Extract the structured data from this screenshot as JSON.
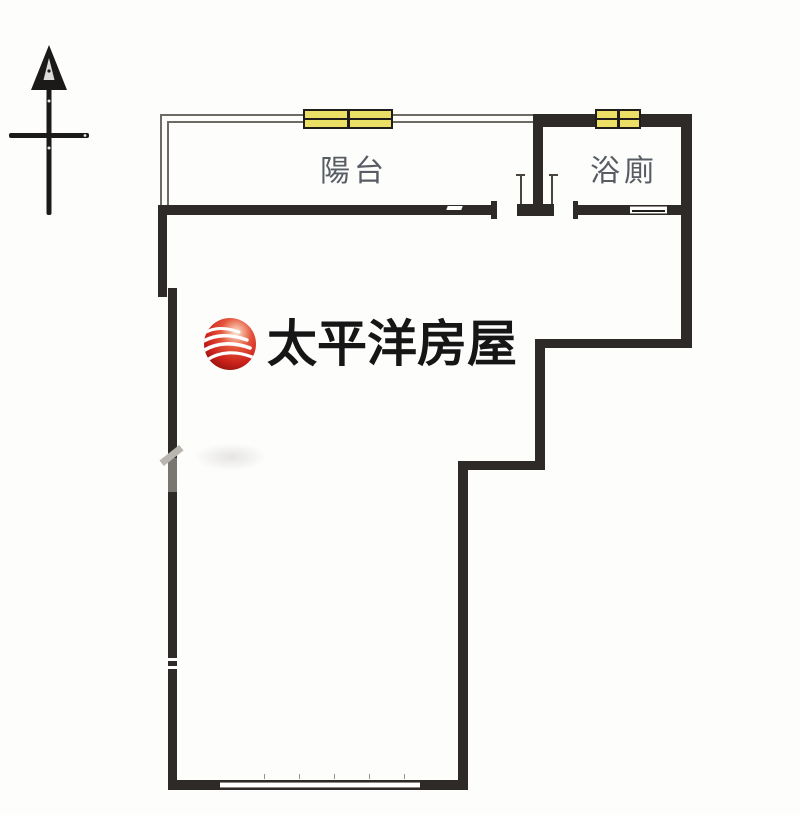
{
  "colors": {
    "background": "#fdfdfc",
    "wall": "#2e2a27",
    "thin_line": "#6e6a64",
    "window_fill": "#ecdf66",
    "window_frame": "#201d1a",
    "label": "#424750",
    "logo_text": "#161616",
    "artifact": "#b9b5af"
  },
  "compass": {
    "icon": "north-arrow"
  },
  "rooms": [
    {
      "id": "balcony",
      "label": "陽台"
    },
    {
      "id": "bathroom",
      "label": "浴廁"
    }
  ],
  "logo": {
    "text": "太平洋房屋",
    "globe": "red-wave-globe",
    "globe_red": "#c9201a",
    "globe_dark": "#7e100b",
    "globe_highlight": "#fde8cf",
    "wave_color": "#ffffff"
  }
}
